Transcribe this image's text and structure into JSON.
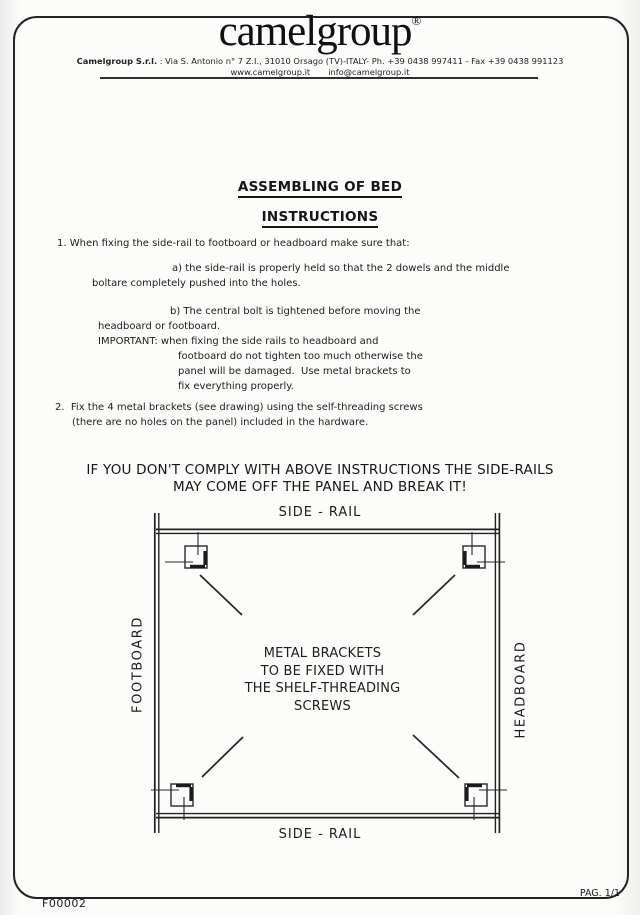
{
  "document": {
    "header": {
      "logo_text": "camelgroup",
      "registered_mark": "®",
      "company_bold": "Camelgroup S.r.l.",
      "company_details": " : Via S. Antonio n° 7 Z.I., 31010 Orsago (TV)-ITALY- Ph. +39 0438 997411 - Fax +39 0438 991123",
      "website": "www.camelgroup.it",
      "email": "info@camelgroup.it"
    },
    "title": "ASSEMBLING OF BED",
    "subtitle": "INSTRUCTIONS",
    "body": {
      "l1": "1. When fixing the side-rail to footboard or headboard make sure that:",
      "l2": "a) the side-rail is properly held so that the 2 dowels and the middle",
      "l3": "boltare completely pushed into the holes.",
      "l4": "b) The central bolt is tightened before moving the",
      "l5": "headboard or footboard.",
      "l6": "IMPORTANT: when fixing the side rails to headboard and",
      "l7": "footboard do not tighten too much otherwise the",
      "l8": "panel will be damaged.  Use metal brackets to",
      "l9": "fix everything properly.",
      "l10": "2.  Fix the 4 metal brackets (see drawing) using the self-threading screws",
      "l11": "(there are no holes on the panel) included in the hardware."
    },
    "warning": {
      "line1": "IF YOU DON'T COMPLY WITH ABOVE INSTRUCTIONS THE SIDE-RAILS",
      "line2": "MAY COME OFF THE PANEL AND BREAK IT!"
    },
    "diagram": {
      "side_rail_top": "SIDE - RAIL",
      "side_rail_bottom": "SIDE - RAIL",
      "footboard": "FOOTBOARD",
      "headboard": "HEADBOARD",
      "center": {
        "line1": "METAL BRACKETS",
        "line2": "TO BE FIXED WITH",
        "line3": "THE SHELF-THREADING",
        "line4": "SCREWS"
      }
    },
    "footer": {
      "form_code": "F00002",
      "page": "PAG. 1/1"
    }
  }
}
